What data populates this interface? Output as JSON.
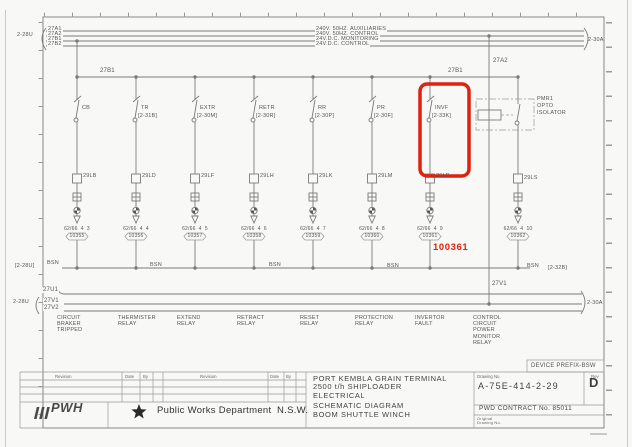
{
  "colors": {
    "highlight_red": "#de2110",
    "line_gray": "#7a7a7a"
  },
  "sheet": {
    "top_buses": {
      "left_ref": "2-28U",
      "right_ref": "2-30A",
      "lines": [
        {
          "id": "27A1",
          "desc": "240V. 50HZ. AUXILIARIES"
        },
        {
          "id": "27A2",
          "desc": "240V. 50HZ. CONTROL"
        },
        {
          "id": "27B1",
          "desc": "24V.D.C. MONITORING"
        },
        {
          "id": "27B2",
          "desc": "24V.D.C. CONTROL"
        }
      ]
    },
    "rail": {
      "label_left": "27B1",
      "label_right": "27B1"
    },
    "tap": {
      "top_label": "27A2",
      "bottom_label": "27V1"
    },
    "branches": [
      {
        "device": "CB",
        "ref": "",
        "coil": "29LB",
        "terminal": "62/66  4  3",
        "wire": "10355",
        "function": "CIRCUIT\nBRAKER\nTRIPPED"
      },
      {
        "device": "TR",
        "ref": "[2-31B]",
        "coil": "29LD",
        "terminal": "62/66  4  4",
        "wire": "10356",
        "function": "THERMISTER\nRELAY"
      },
      {
        "device": "EXTR",
        "ref": "[2-30M]",
        "coil": "29LF",
        "terminal": "62/66  4  5",
        "wire": "10357",
        "function": "EXTEND\nRELAY"
      },
      {
        "device": "RETR",
        "ref": "[2-30R]",
        "coil": "29LH",
        "terminal": "62/66  4  6",
        "wire": "10358",
        "function": "RETRACT\nRELAY"
      },
      {
        "device": "RR",
        "ref": "[2-30P]",
        "coil": "29LK",
        "terminal": "62/66  4  7",
        "wire": "10359",
        "function": "RESET\nRELAY"
      },
      {
        "device": "PR",
        "ref": "[2-30F]",
        "coil": "29LM",
        "terminal": "62/66  4  8",
        "wire": "10360",
        "function": "PROTECTION\nRELAY"
      },
      {
        "device": "INVF",
        "ref": "[2-33K]",
        "coil": "29LP",
        "terminal": "62/66  4  9",
        "wire": "10361",
        "function": "INVERTOR\nFAULT"
      },
      {
        "device": "PMR1\nOPTO\nISOLATOR",
        "ref": "",
        "coil": "29LS",
        "terminal": "62/66  4  10",
        "wire": "10362",
        "function": "CONTROL\nCIRCUIT\nPOWER\nMONITOR\nRELAY"
      }
    ],
    "bsn": {
      "left_ref": "[2-28U]",
      "labels": [
        "BSN",
        "BSN",
        "BSN",
        "BSN",
        "BSN"
      ],
      "right_ref": "[2-32B]"
    },
    "bottom_buses": {
      "left_ref": "2-28U",
      "right_ref": "2-30A",
      "ids": [
        "27U1",
        "27V1",
        "27V2"
      ]
    },
    "annotations": {
      "highlight_wire": "100361",
      "device_prefix": "DEVICE PREFIX-BSW"
    }
  },
  "title_block": {
    "revision_header": {
      "revision": "Revision",
      "date": "Date",
      "by": "By"
    },
    "org_logo": "PWH",
    "org_name": "Public Works Department",
    "org_region": "N.S.W.",
    "project_lines": [
      "PORT KEMBLA GRAIN TERMINAL",
      "2500 t/h SHIPLOADER",
      "ELECTRICAL",
      "SCHEMATIC DIAGRAM",
      "BOOM SHUTTLE WINCH"
    ],
    "drawing_no_label": "Drawing No.",
    "drawing_no": "A-75E-414-2-29",
    "rev_label": "Rev",
    "rev": "D",
    "contract": "PWD CONTRACT No. 85011",
    "original_label": "Original\nDrawing No."
  }
}
